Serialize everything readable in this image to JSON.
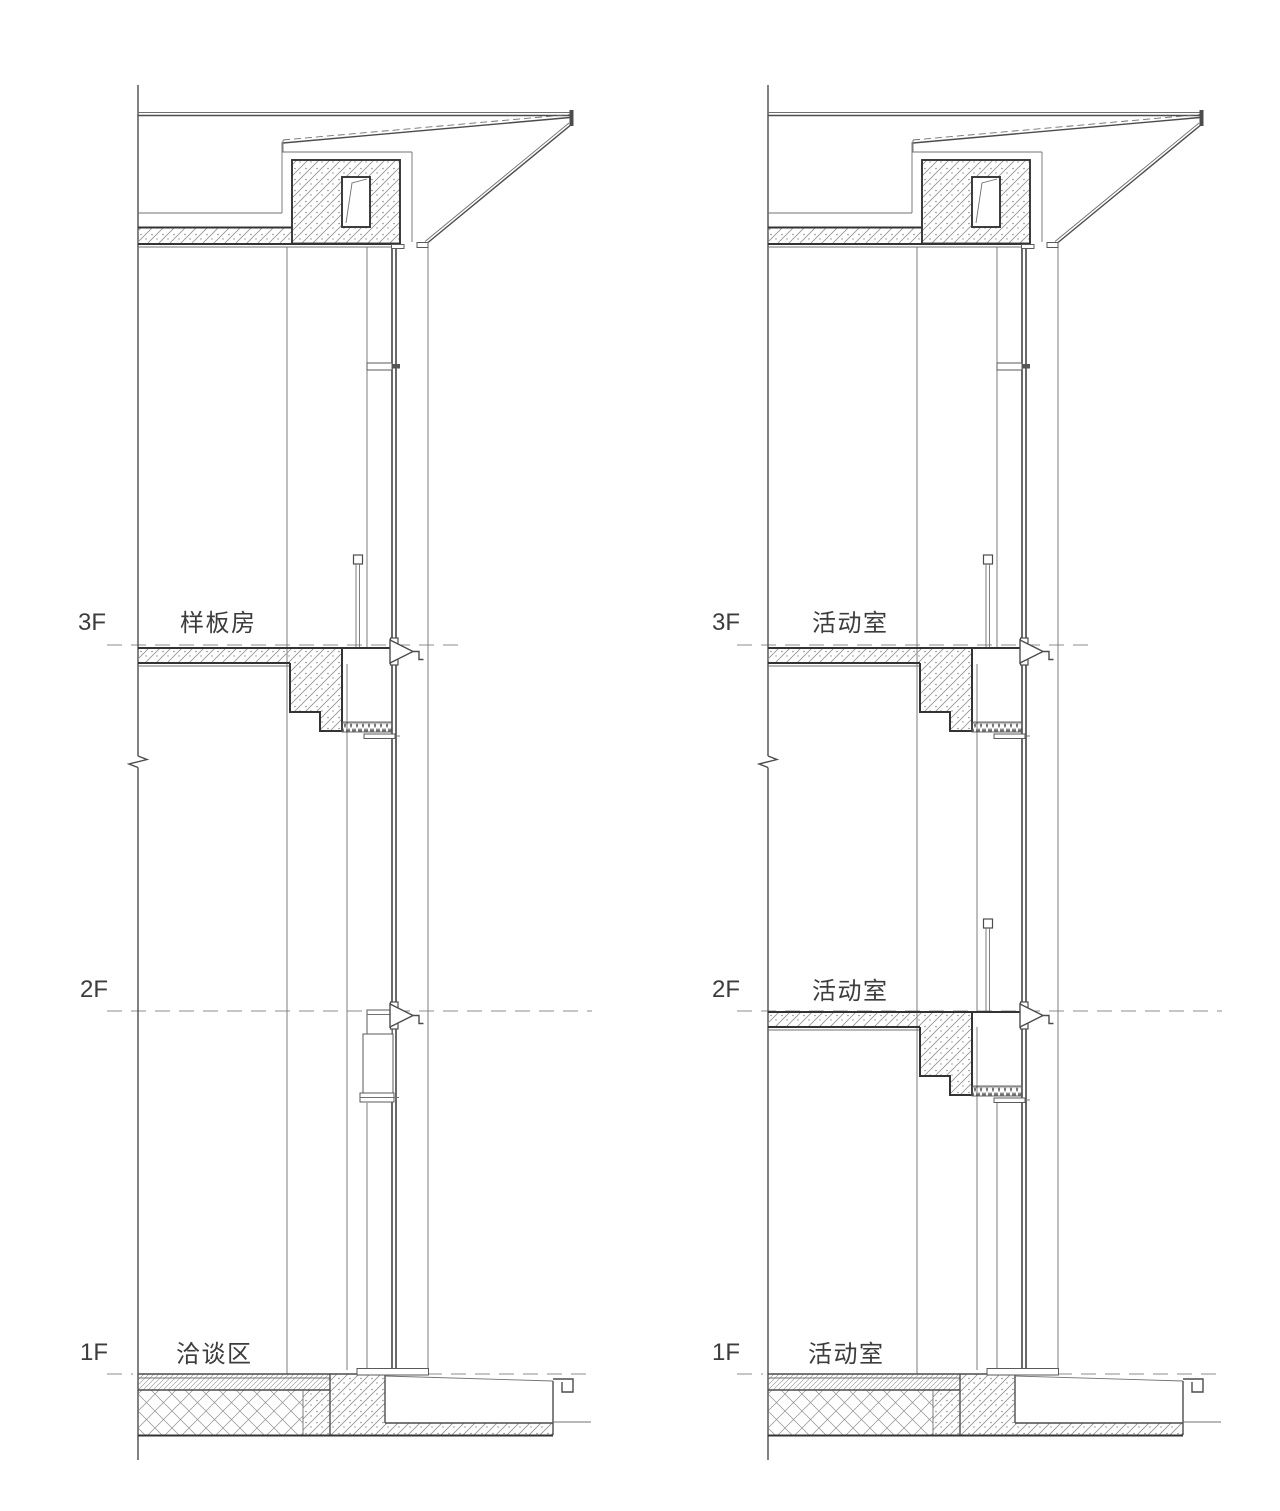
{
  "page": {
    "background": "#ffffff",
    "drawing_type": "wall-section-details"
  },
  "sections": [
    {
      "name": "left-wall-section",
      "levels": [
        {
          "level": "3F",
          "room": "样板房"
        },
        {
          "level": "2F",
          "room": ""
        },
        {
          "level": "1F",
          "room": "洽谈区"
        }
      ]
    },
    {
      "name": "right-wall-section",
      "levels": [
        {
          "level": "3F",
          "room": "活动室"
        },
        {
          "level": "2F",
          "room": "活动室"
        },
        {
          "level": "1F",
          "room": "活动室"
        }
      ]
    }
  ],
  "colors": {
    "line_main": "#4c4c4c",
    "line_heavy": "#333333",
    "line_light": "#707070",
    "level_dash": "#8c8c8c",
    "text": "#3c3c3c"
  }
}
